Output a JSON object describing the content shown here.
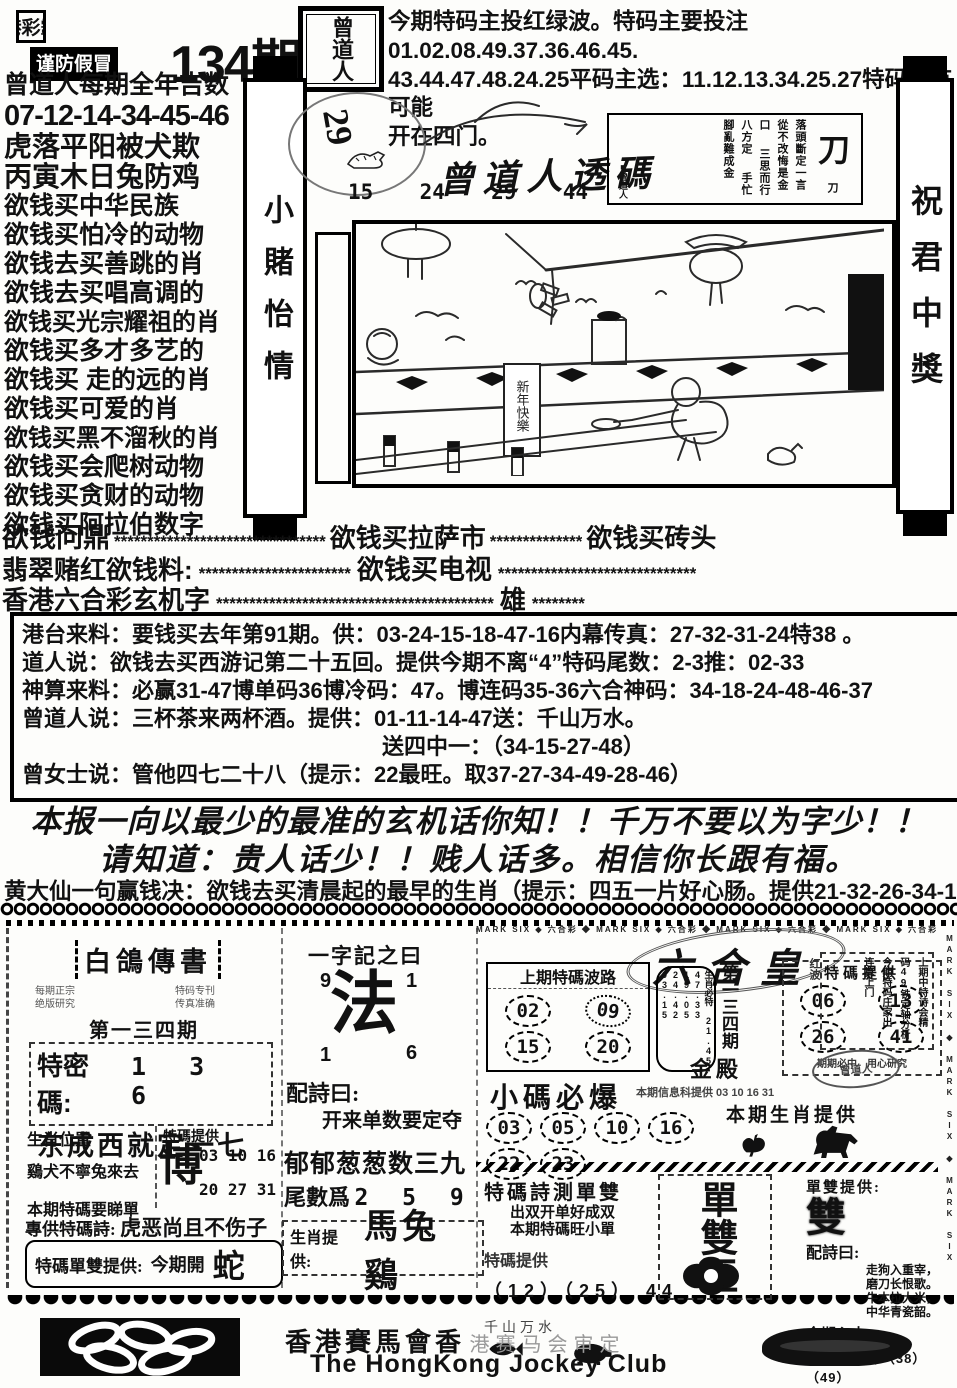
{
  "header": {
    "masthead_line1": "香港彩霸王",
    "masthead_line2": "谨防假冒",
    "issue": "134期",
    "seal": "曾道人",
    "right_l1": "今期特码主投红绿波。特码主要投注01.02.08.49.37.36.46.45.",
    "right_l2": "43.44.47.48.24.25平码主选：11.12.13.34.25.27特码很有可能",
    "right_l3": "开在四门。"
  },
  "left_column": {
    "lines": [
      "曾道人每期全年吉数",
      "07-12-14-34-45-46",
      "虎落平阳被犬欺",
      "丙寅木日兔防鸡",
      "欲钱买中华民族",
      "欲钱买怕冷的动物",
      "欲钱去买善跳的肖",
      "欲钱去买唱高调的",
      "欲钱买光宗耀祖的肖",
      "欲钱买多才多艺的",
      "欲钱买 走的远的肖",
      "欲钱买可爱的肖",
      "欲钱买黑不溜秋的肖",
      "欲钱买会爬树动物",
      "欲钱买贪财的动物",
      "欲钱买阿拉伯数字"
    ]
  },
  "banners": {
    "left": "小賭怡情",
    "right": "祝君中獎"
  },
  "touma": {
    "circle_number": "29",
    "title": "曾道人透碼",
    "n1": "15",
    "n2": "24",
    "n3": "29",
    "n4": "44"
  },
  "knife_box": {
    "big": "刀",
    "c1": "刀落頭斷定一言",
    "c2": "從不改悔是金口",
    "c3": "三思而行八方定",
    "c4": "手忙腳亂難成金",
    "sig": "■曾道人"
  },
  "illustration": {
    "banner": "新年快樂"
  },
  "star_lines": {
    "l1a": "欲钱问鼎",
    "l1s1": "********************************",
    "l1b": "欲钱买拉萨市",
    "l1s2": "**************",
    "l1c": "欲钱买砖头",
    "l2a": "翡翠赌红欲钱料:",
    "l2s1": "***********************",
    "l2b": "欲钱买电视",
    "l2s2": "******************************",
    "l3a": "香港六合彩玄机字",
    "l3s1": "******************************************",
    "l3b": "雄",
    "l3s2": "********"
  },
  "info_box": {
    "l1": "港台来料：要钱买去年第91期。供：03-24-15-18-47-16内幕传真：27-32-31-24特38 。",
    "l2": "道人说：欲钱去买西游记第二十五回。提供今期不离“4”特码尾数：2-3推：02-33",
    "l3": "神算来料：必赢31-47博单码36博冷码：47。博连码35-36六合神码：34-18-24-48-46-37",
    "l4": "曾道人说：三杯茶来两杯酒。提供：01-11-14-47送：千山万水。",
    "l5": "送四中一：（34-15-27-48）",
    "l6": "曾女士说：管他四七二十八（提示：22最旺。取37-27-34-49-28-46）"
  },
  "slogans": {
    "l1": "本报一向以最少的最准的玄机话你知！！千万不要以为字少！！",
    "l2": "请知道：贵人话少！！贱人话多。相信你长跟有福。",
    "l3": "黄大仙一句赢钱决：欲钱去买清晨起的最早的生肖（提示：四五一片好心肠。提供21-32-26-34-16-48）"
  },
  "pigeon": {
    "title": "白鴿傳書",
    "small_left1": "每期正宗",
    "small_left2": "绝版研究",
    "small_right1": "特码专刊",
    "small_right2": "传真准确",
    "issue": "第一三四期",
    "code_label": "特密碼:",
    "code": "1 3 6",
    "phrase": "东成西就定一七",
    "th1": "生肖位置",
    "th2": "特碼提供",
    "row1": "鷄犬不寧兔來去",
    "row2": "本期特碼要睇單",
    "big": "博",
    "nums1": "03 10 16",
    "nums2": "20 27 31",
    "poem_label": "專供特碼詩:",
    "poem": "虎恶尚且不伤子",
    "ds_label": "特碼單雙提供:",
    "ds_text": "今期開",
    "ds_big": "蛇"
  },
  "fa_box": {
    "title": "一字記之曰",
    "tl": "9",
    "tr": "1",
    "bl": "1",
    "br": "6",
    "big": "法",
    "peishi_label": "配詩曰:",
    "peishi": "开来单数要定夺",
    "line2": "郁郁葱葱数三九",
    "tail_label": "尾數爲",
    "tail": "2 5 9",
    "sx_label": "生肖提供:",
    "sx": "馬兔鷄"
  },
  "liuhe": {
    "title": "六合皇",
    "bolou_title": "上期特碼波路",
    "b1": "02",
    "b2": "09",
    "b3": "15",
    "b4": "20",
    "mid_title": "生肖必特",
    "midn1": "21.45",
    "midn2": "47.33",
    "midn3": "19.05",
    "midn4": "24.42",
    "midn5": "03.15",
    "issue": "第一三四期",
    "hall": "金殿",
    "tema_title": "特碼提供",
    "t1": "06",
    "t2": "13",
    "t3": "26",
    "t4": "41",
    "note1": "期期必中",
    "note2": "用心研究",
    "xiaoma_title": "小碼必爆",
    "x1": "03",
    "x2": "05",
    "x3": "10",
    "x4": "16",
    "x5": "22",
    "x6": "23",
    "info_small": "本期信息科提供 03 10 16 31",
    "sx_title": "本期生肖提供"
  },
  "danshuang": {
    "title": "特碼詩測單雙",
    "poem1": "出双开单好成双",
    "poem2": "本期特碼旺小單",
    "tema_label": "特碼提供",
    "nums": "（12）（25） 44",
    "small": "千山万水",
    "big": "單雙王"
  },
  "right_col": {
    "box1": "上期中特诗会精",
    "box2": "码49铁定轴分析",
    "box3": "今期特码庄家出",
    "box4": "连算上门",
    "side": "红波",
    "ds_label": "單雙提供:",
    "ds_big": "雙",
    "peishi_label": "配詩曰:",
    "p1": "走狗入重宰，",
    "p2": "磨刀长恨歌。",
    "p3": "牛本拉大米，",
    "p4": "中华青瓷韶。",
    "xinshui_label": "今期心水:",
    "xinshui": "（02）（15）（38）（49）"
  },
  "borders": {
    "mark_six": "MARK SIX ◆ 六合彩 ◆ MARK SIX ◆ 六合彩 ◆ MARK SIX ◆ 六合彩 ◆ MARK SIX ◆ 六合彩 ◆ MARK SIX",
    "mark_six_v": "MARK SIX ◆ MARK SIX ◆ MARK SIX ◆ MARK SIX"
  },
  "footer": {
    "cn": "香港賽馬會香",
    "cn_faded": "港赛马会审定",
    "en": "The HongKong Jockey Club"
  }
}
